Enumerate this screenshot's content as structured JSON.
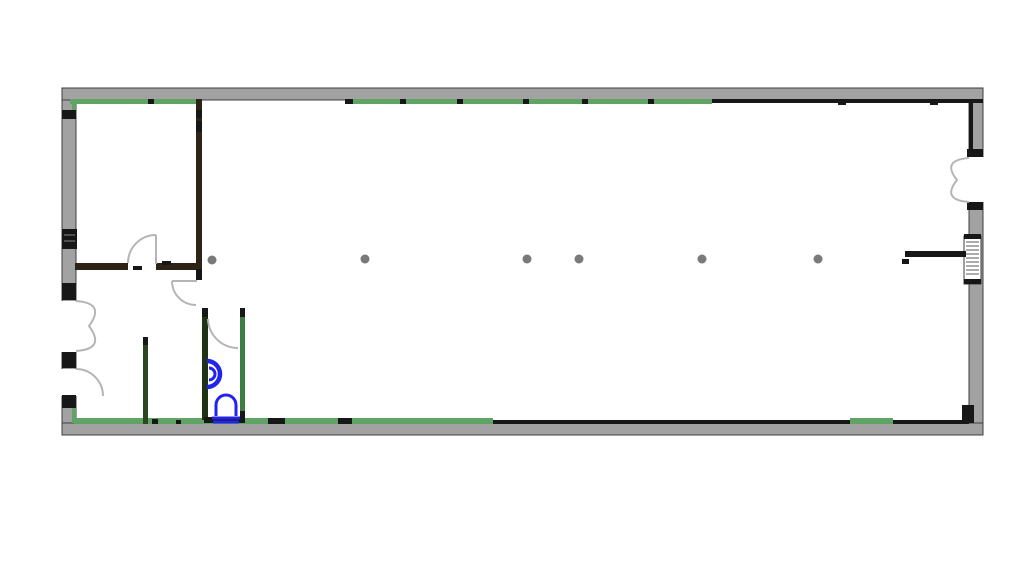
{
  "canvas": {
    "width": 1024,
    "height": 575,
    "background": "#ffffff"
  },
  "palette": {
    "white": "#ffffff",
    "wallGray": "#a2a2a2",
    "wallEdge": "#3f3f3f",
    "black": "#171717",
    "green": "#5fa465",
    "darkGreen": "#2c461f",
    "bathGreen": "#3e7d44",
    "bathDark": "#1f3315",
    "brown": "#2d2416",
    "doorArc": "#b5b5b5",
    "column": "#7a7a7a",
    "fixtureBlue": "#2323ee",
    "hatch": "#5a5a5a",
    "hatchLight": "#8a8a8a"
  },
  "drawing": {
    "shapes": [
      {
        "t": "rect",
        "n": "left-exterior-wall",
        "x": 62,
        "y": 88,
        "w": 14,
        "h": 347,
        "f": "wallGray",
        "s": "wallEdge",
        "sw": 1
      },
      {
        "t": "rect",
        "n": "right-exterior-wall",
        "x": 969,
        "y": 88,
        "w": 14,
        "h": 347,
        "f": "wallGray",
        "s": "wallEdge",
        "sw": 1
      },
      {
        "t": "rect",
        "n": "top-exterior-wall",
        "x": 62,
        "y": 88,
        "w": 921,
        "h": 12,
        "f": "wallGray",
        "s": "wallEdge",
        "sw": 1
      },
      {
        "t": "rect",
        "n": "bottom-exterior-wall",
        "x": 62,
        "y": 423,
        "w": 921,
        "h": 12,
        "f": "wallGray",
        "s": "wallEdge",
        "sw": 1
      },
      {
        "t": "rect",
        "n": "right-door-opening",
        "x": 964,
        "y": 157,
        "w": 24,
        "h": 45,
        "f": "white"
      },
      {
        "t": "rect",
        "n": "left-double-door-opening",
        "x": 58,
        "y": 301,
        "w": 20,
        "h": 51,
        "f": "white"
      },
      {
        "t": "rect",
        "n": "left-single-door-opening",
        "x": 58,
        "y": 369,
        "w": 20,
        "h": 27,
        "f": "white"
      },
      {
        "t": "rect",
        "n": "top-wall-inner-green-left",
        "x": 70,
        "y": 99,
        "w": 126,
        "h": 5,
        "f": "green"
      },
      {
        "t": "rect",
        "n": "top-wall-inner-green-mid",
        "x": 345,
        "y": 99,
        "w": 367,
        "h": 5,
        "f": "green"
      },
      {
        "t": "rect",
        "n": "top-wall-inner-black-right",
        "x": 712,
        "y": 99,
        "w": 271,
        "h": 4,
        "f": "black"
      },
      {
        "t": "rect",
        "n": "right-wall-inner-black-top",
        "x": 969,
        "y": 101,
        "w": 4,
        "h": 54,
        "f": "black"
      },
      {
        "t": "rect",
        "n": "left-wall-inner-green-top",
        "x": 72,
        "y": 100,
        "w": 4,
        "h": 13,
        "f": "green"
      },
      {
        "t": "rect",
        "n": "bottom-wall-inner-green-left",
        "x": 74,
        "y": 418,
        "w": 419,
        "h": 6,
        "f": "green"
      },
      {
        "t": "rect",
        "n": "bottom-wall-inner-black-mid",
        "x": 493,
        "y": 420,
        "w": 357,
        "h": 4,
        "f": "black"
      },
      {
        "t": "rect",
        "n": "bottom-wall-inner-green-right",
        "x": 850,
        "y": 418,
        "w": 43,
        "h": 6,
        "f": "green"
      },
      {
        "t": "rect",
        "n": "bottom-wall-inner-black-right",
        "x": 893,
        "y": 420,
        "w": 76,
        "h": 4,
        "f": "black"
      },
      {
        "t": "rect",
        "n": "left-wall-inner-green-bottom",
        "x": 72,
        "y": 406,
        "w": 4,
        "h": 17,
        "f": "green"
      },
      {
        "t": "rect",
        "n": "left-wall-cap-1",
        "x": 62,
        "y": 110,
        "w": 14,
        "h": 9,
        "f": "black"
      },
      {
        "t": "rect",
        "n": "left-wall-cap-2",
        "x": 62,
        "y": 283,
        "w": 14,
        "h": 17,
        "f": "black"
      },
      {
        "t": "rect",
        "n": "left-wall-cap-3",
        "x": 62,
        "y": 352,
        "w": 14,
        "h": 16,
        "f": "black"
      },
      {
        "t": "rect",
        "n": "left-wall-cap-4",
        "x": 62,
        "y": 395,
        "w": 14,
        "h": 13,
        "f": "black"
      },
      {
        "t": "rect",
        "n": "right-wall-cap-1",
        "x": 967,
        "y": 149,
        "w": 16,
        "h": 8,
        "f": "black"
      },
      {
        "t": "rect",
        "n": "right-wall-cap-2",
        "x": 967,
        "y": 202,
        "w": 16,
        "h": 8,
        "f": "black"
      },
      {
        "t": "rect",
        "n": "bottom-right-corner-notch",
        "x": 962,
        "y": 405,
        "w": 12,
        "h": 18,
        "f": "black"
      },
      {
        "t": "rect",
        "n": "left-wall-window",
        "x": 62,
        "y": 229,
        "w": 15,
        "h": 20,
        "f": "black"
      },
      {
        "t": "path",
        "n": "left-wall-window-hatch",
        "d": "M64,235 H75 M64,241 H75",
        "s": "hatchLight",
        "sw": 1
      },
      {
        "t": "rect",
        "n": "right-wall-window",
        "x": 964,
        "y": 236,
        "w": 17,
        "h": 48,
        "f": "white",
        "s": "wallEdge",
        "sw": 1
      },
      {
        "t": "rect",
        "n": "right-wall-window-cap-top",
        "x": 964,
        "y": 234,
        "w": 17,
        "h": 5,
        "f": "black"
      },
      {
        "t": "rect",
        "n": "right-wall-window-cap-bot",
        "x": 964,
        "y": 279,
        "w": 17,
        "h": 5,
        "f": "black"
      },
      {
        "t": "path",
        "n": "right-wall-window-hatch",
        "d": "M966,242 H979 M966,246 H979 M966,250 H979 M966,254 H979 M966,258 H979 M966,262 H979 M966,266 H979 M966,270 H979 M966,274 H979",
        "s": "hatch",
        "sw": 1
      },
      {
        "t": "rect",
        "n": "top-wall-joint-1",
        "x": 148,
        "y": 99,
        "w": 6,
        "h": 5,
        "f": "black"
      },
      {
        "t": "rect",
        "n": "top-wall-joint-2",
        "x": 345,
        "y": 99,
        "w": 8,
        "h": 5,
        "f": "black"
      },
      {
        "t": "rect",
        "n": "top-wall-joint-3",
        "x": 400,
        "y": 99,
        "w": 6,
        "h": 5,
        "f": "black"
      },
      {
        "t": "rect",
        "n": "top-wall-joint-4",
        "x": 457,
        "y": 99,
        "w": 6,
        "h": 5,
        "f": "black"
      },
      {
        "t": "rect",
        "n": "top-wall-joint-5",
        "x": 523,
        "y": 99,
        "w": 6,
        "h": 5,
        "f": "black"
      },
      {
        "t": "rect",
        "n": "top-wall-joint-6",
        "x": 582,
        "y": 99,
        "w": 6,
        "h": 5,
        "f": "black"
      },
      {
        "t": "rect",
        "n": "top-wall-joint-7",
        "x": 648,
        "y": 99,
        "w": 6,
        "h": 5,
        "f": "black"
      },
      {
        "t": "rect",
        "n": "top-wall-joint-8",
        "x": 838,
        "y": 99,
        "w": 8,
        "h": 6,
        "f": "black"
      },
      {
        "t": "rect",
        "n": "top-wall-joint-9",
        "x": 930,
        "y": 99,
        "w": 8,
        "h": 6,
        "f": "black"
      },
      {
        "t": "rect",
        "n": "bottom-wall-joint-1",
        "x": 152,
        "y": 419,
        "w": 6,
        "h": 5,
        "f": "black"
      },
      {
        "t": "rect",
        "n": "bottom-wall-joint-2",
        "x": 176,
        "y": 420,
        "w": 5,
        "h": 4,
        "f": "black"
      },
      {
        "t": "rect",
        "n": "bottom-wall-joint-3",
        "x": 268,
        "y": 418,
        "w": 17,
        "h": 6,
        "f": "black"
      },
      {
        "t": "rect",
        "n": "bottom-wall-joint-4",
        "x": 338,
        "y": 418,
        "w": 14,
        "h": 6,
        "f": "black"
      },
      {
        "t": "rect",
        "n": "upper-left-partition-vertical",
        "x": 196,
        "y": 99,
        "w": 6,
        "h": 181,
        "f": "brown"
      },
      {
        "t": "rect",
        "n": "partition-joint-1",
        "x": 196,
        "y": 110,
        "w": 6,
        "h": 8,
        "f": "black"
      },
      {
        "t": "rect",
        "n": "partition-joint-2",
        "x": 196,
        "y": 121,
        "w": 6,
        "h": 11,
        "f": "black"
      },
      {
        "t": "rect",
        "n": "partition-end-cap",
        "x": 196,
        "y": 269,
        "w": 6,
        "h": 11,
        "f": "black"
      },
      {
        "t": "rect",
        "n": "upper-left-partition-horiz-a",
        "x": 75,
        "y": 263,
        "w": 53,
        "h": 7,
        "f": "brown"
      },
      {
        "t": "rect",
        "n": "upper-left-partition-horiz-b",
        "x": 156,
        "y": 263,
        "w": 40,
        "h": 7,
        "f": "brown"
      },
      {
        "t": "rect",
        "n": "door-jamb-mark-a",
        "x": 133,
        "y": 266,
        "w": 9,
        "h": 4,
        "f": "black"
      },
      {
        "t": "rect",
        "n": "door-jamb-mark-b",
        "x": 162,
        "y": 261,
        "w": 9,
        "h": 4,
        "f": "black"
      },
      {
        "t": "rect",
        "n": "stub-wall",
        "x": 143,
        "y": 337,
        "w": 5,
        "h": 87,
        "f": "darkGreen"
      },
      {
        "t": "rect",
        "n": "stub-wall-cap",
        "x": 143,
        "y": 337,
        "w": 5,
        "h": 8,
        "f": "black"
      },
      {
        "t": "rect",
        "n": "bathroom-left-wall",
        "x": 202,
        "y": 308,
        "w": 6,
        "h": 112,
        "f": "bathDark"
      },
      {
        "t": "rect",
        "n": "bathroom-left-wall-cap",
        "x": 202,
        "y": 308,
        "w": 6,
        "h": 9,
        "f": "black"
      },
      {
        "t": "rect",
        "n": "bathroom-right-wall",
        "x": 240,
        "y": 308,
        "w": 5,
        "h": 112,
        "f": "bathGreen"
      },
      {
        "t": "rect",
        "n": "bathroom-right-wall-cap-top",
        "x": 240,
        "y": 308,
        "w": 5,
        "h": 9,
        "f": "black"
      },
      {
        "t": "rect",
        "n": "bathroom-right-wall-cap-bot",
        "x": 240,
        "y": 411,
        "w": 5,
        "h": 9,
        "f": "black"
      },
      {
        "t": "rect",
        "n": "bathroom-threshold",
        "x": 204,
        "y": 417,
        "w": 41,
        "h": 6,
        "f": "black"
      },
      {
        "t": "rect",
        "n": "right-partition-stub",
        "x": 905,
        "y": 251,
        "w": 61,
        "h": 6,
        "f": "black"
      },
      {
        "t": "rect",
        "n": "right-partition-stub-tick",
        "x": 902,
        "y": 259,
        "w": 7,
        "h": 5,
        "f": "black"
      },
      {
        "t": "path",
        "n": "door-swing-room1",
        "d": "M128,263 A28,28 0 0 1 156,235 M156,235 L156,264",
        "s": "doorArc",
        "sw": 2
      },
      {
        "t": "path",
        "n": "door-swing-room2",
        "d": "M172,281 A24,24 0 0 0 196,305 M172,281 L197,281",
        "s": "doorArc",
        "sw": 2
      },
      {
        "t": "path",
        "n": "door-swing-bathroom",
        "d": "M208,319 A30,30 0 0 0 238,348",
        "s": "doorArc",
        "sw": 2
      },
      {
        "t": "path",
        "n": "door-swing-left-double",
        "d": "M76,301 Q106,303 89,326 Q106,349 76,351",
        "s": "doorArc",
        "sw": 2
      },
      {
        "t": "path",
        "n": "door-swing-left-single",
        "d": "M76,369 A27,27 0 0 1 103,396",
        "s": "doorArc",
        "sw": 2
      },
      {
        "t": "path",
        "n": "door-swing-right-double",
        "d": "M969,158 Q941,160 957,180 Q941,200 969,202",
        "s": "doorArc",
        "sw": 2
      },
      {
        "t": "circle",
        "n": "column-1",
        "cx": 212,
        "cy": 260,
        "r": 4.5,
        "f": "column"
      },
      {
        "t": "circle",
        "n": "column-2",
        "cx": 365,
        "cy": 259,
        "r": 4.5,
        "f": "column"
      },
      {
        "t": "circle",
        "n": "column-3",
        "cx": 527,
        "cy": 259,
        "r": 4.5,
        "f": "column"
      },
      {
        "t": "circle",
        "n": "column-4",
        "cx": 579,
        "cy": 259,
        "r": 4.5,
        "f": "column"
      },
      {
        "t": "circle",
        "n": "column-5",
        "cx": 702,
        "cy": 259,
        "r": 4.5,
        "f": "column"
      },
      {
        "t": "circle",
        "n": "column-6",
        "cx": 818,
        "cy": 259,
        "r": 4.5,
        "f": "column"
      },
      {
        "t": "path",
        "n": "urinal-fixture-outer",
        "d": "M207,361 A13,13 0 0 1 207,387",
        "s": "fixtureBlue",
        "sw": 4.5
      },
      {
        "t": "path",
        "n": "urinal-fixture-inner",
        "d": "M209,368 A6,6 0 0 1 209,380",
        "s": "fixtureBlue",
        "sw": 3
      },
      {
        "t": "path",
        "n": "toilet-fixture-bowl",
        "d": "M216,416 L216,405 A10,10 0 0 1 236,405 L236,416",
        "s": "fixtureBlue",
        "sw": 3
      },
      {
        "t": "path",
        "n": "toilet-fixture-base",
        "d": "M212,418 L240,418 M213,422 L239,422",
        "s": "fixtureBlue",
        "sw": 3
      }
    ]
  }
}
